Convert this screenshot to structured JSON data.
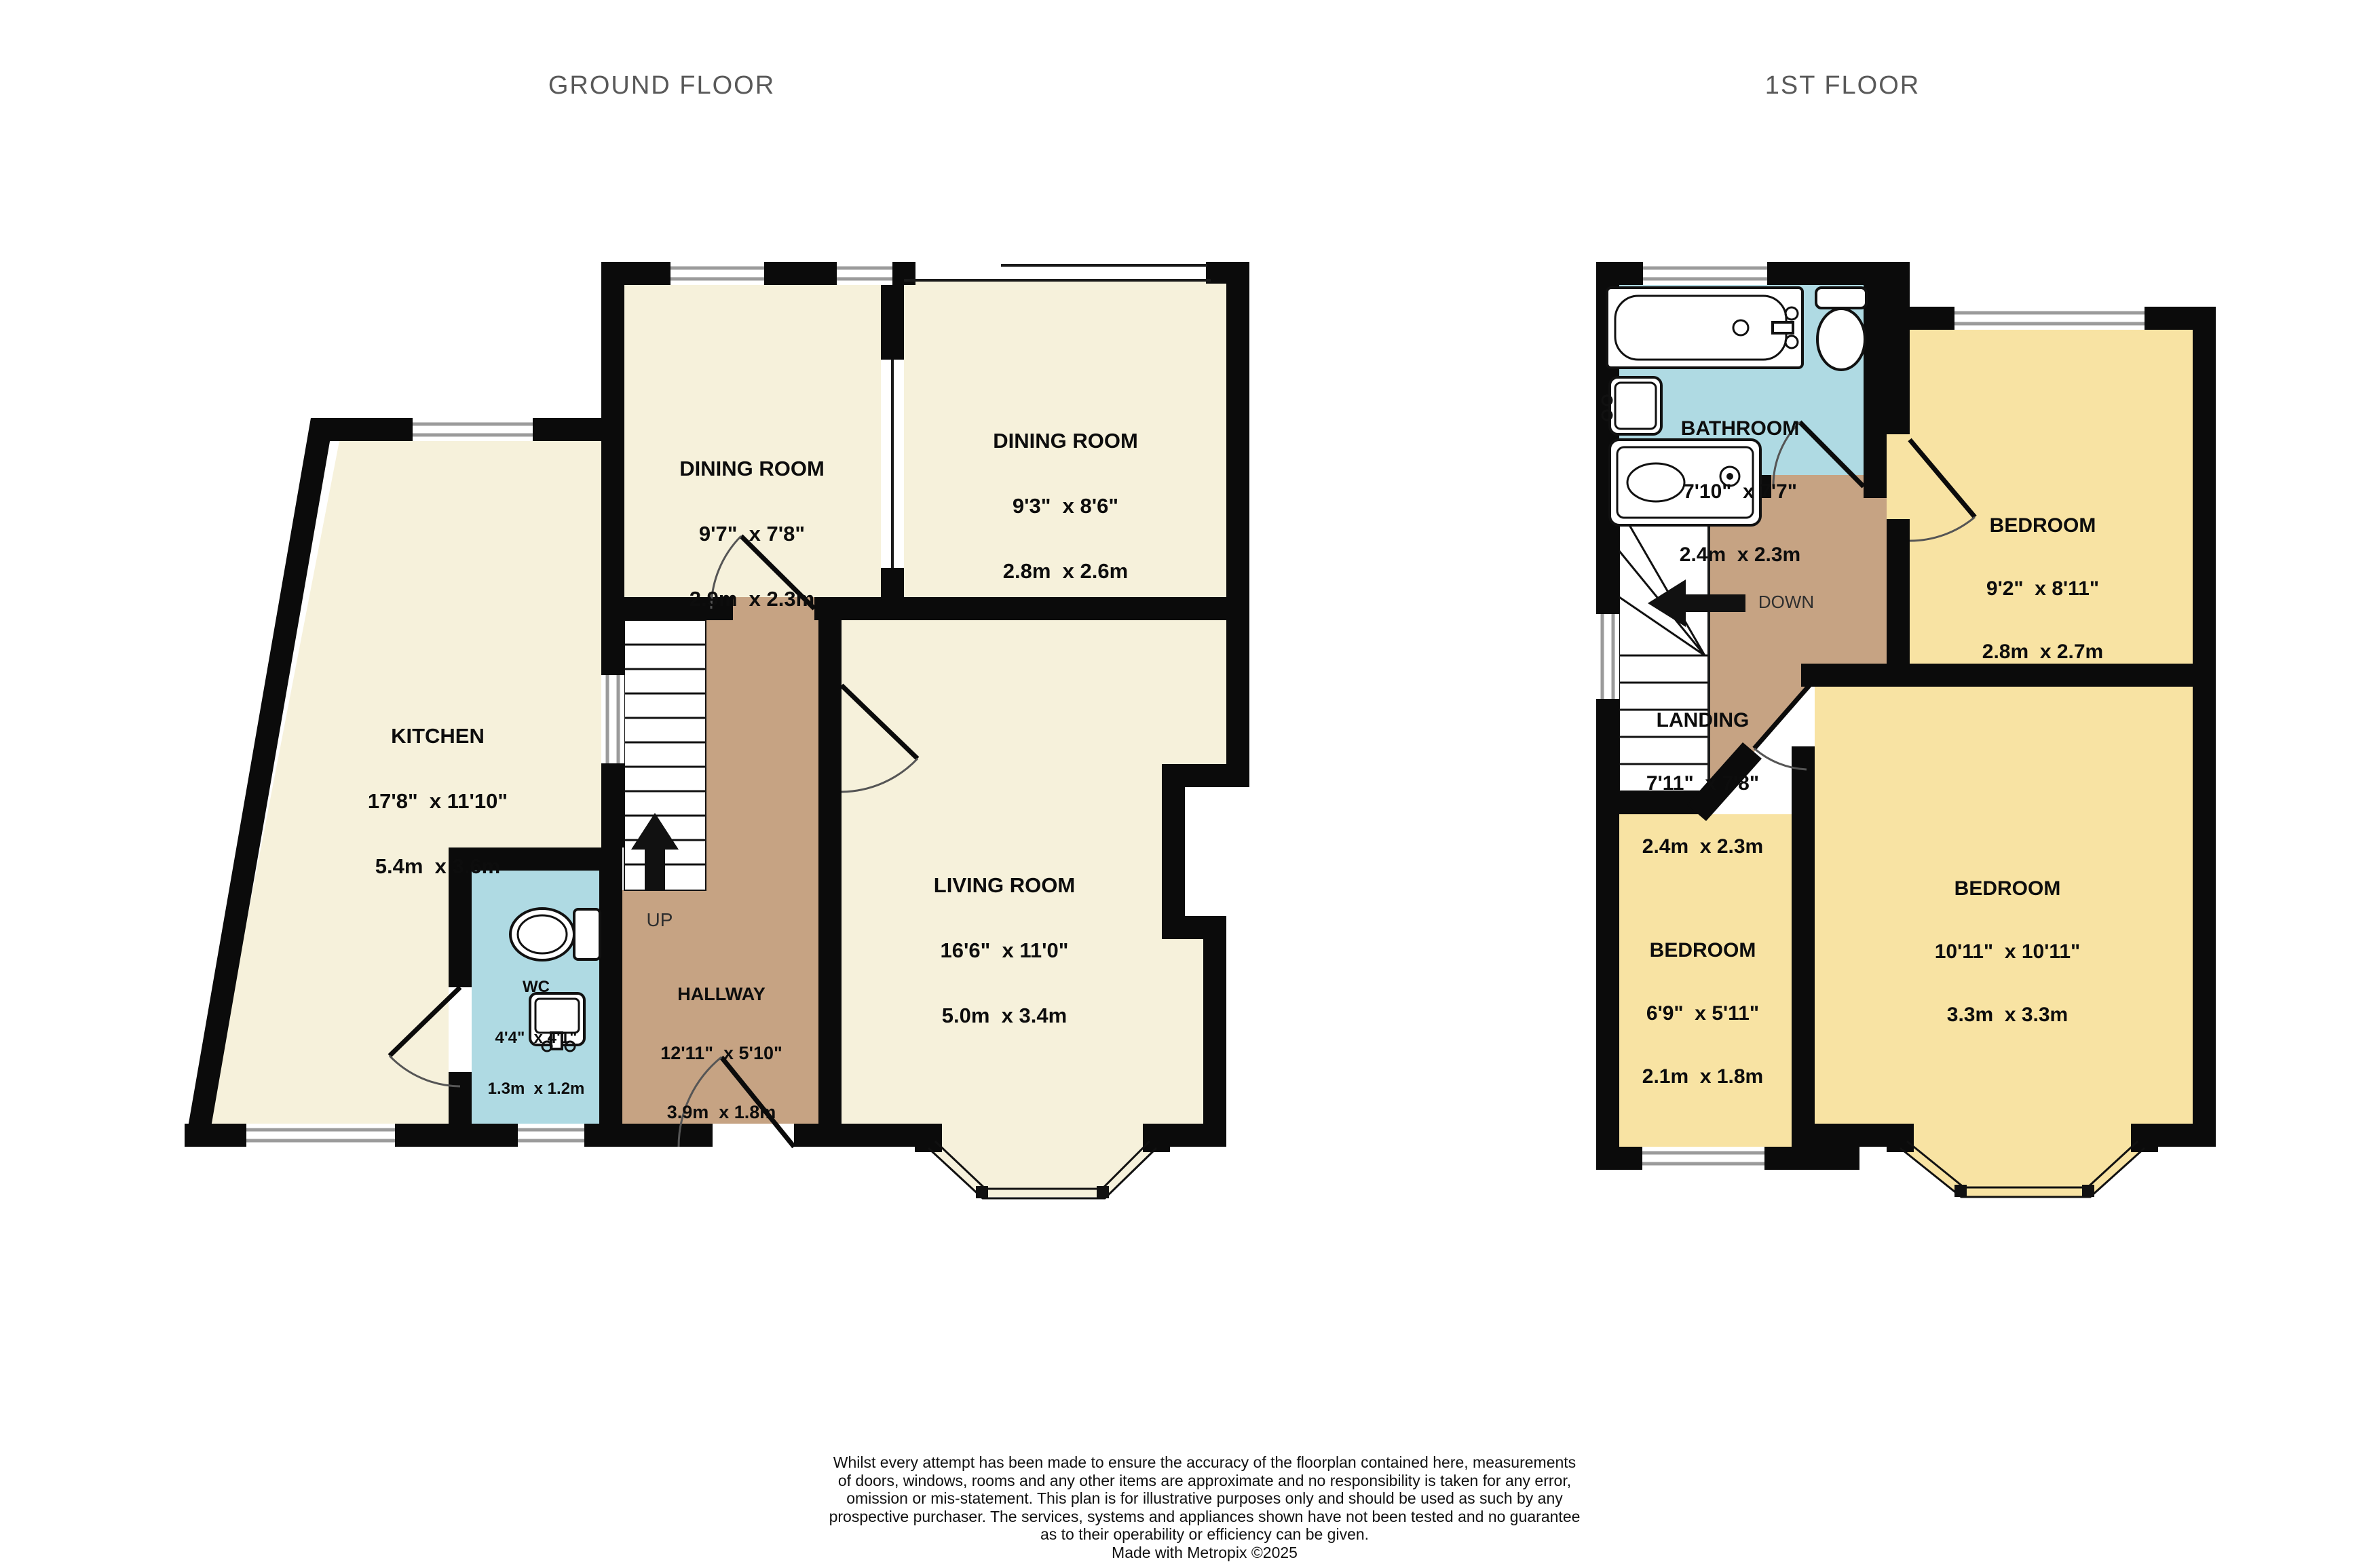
{
  "titles": {
    "ground": "GROUND FLOOR",
    "first": "1ST FLOOR"
  },
  "ground_floor": {
    "up_label": "UP",
    "rooms": {
      "dining1": {
        "name": "DINING ROOM",
        "imperial": "9'7\"  x 7'8\"",
        "metric": "2.9m  x 2.3m"
      },
      "dining2": {
        "name": "DINING ROOM",
        "imperial": "9'3\"  x 8'6\"",
        "metric": "2.8m  x 2.6m"
      },
      "kitchen": {
        "name": "KITCHEN",
        "imperial": "17'8\"  x 11'10\"",
        "metric": "5.4m  x 3.6m"
      },
      "living": {
        "name": "LIVING ROOM",
        "imperial": "16'6\"  x 11'0\"",
        "metric": "5.0m  x 3.4m"
      },
      "wc": {
        "name": "WC",
        "imperial": "4'4\"  x 4'1\"",
        "metric": "1.3m  x 1.2m"
      },
      "hallway": {
        "name": "HALLWAY",
        "imperial": "12'11\"  x 5'10\"",
        "metric": "3.9m  x 1.8m"
      }
    }
  },
  "first_floor": {
    "down_label": "DOWN",
    "rooms": {
      "bathroom": {
        "name": "BATHROOM",
        "imperial": "7'10\"  x 7'7\"",
        "metric": "2.4m  x 2.3m"
      },
      "bedroom1": {
        "name": "BEDROOM",
        "imperial": "9'2\"  x 8'11\"",
        "metric": "2.8m  x 2.7m"
      },
      "landing": {
        "name": "LANDING",
        "imperial": "7'11\"  x 7'8\"",
        "metric": "2.4m  x 2.3m"
      },
      "bedroom_small": {
        "name": "BEDROOM",
        "imperial": "6'9\"  x 5'11\"",
        "metric": "2.1m  x 1.8m"
      },
      "bedroom_big": {
        "name": "BEDROOM",
        "imperial": "10'11\"  x 10'11\"",
        "metric": "3.3m  x 3.3m"
      }
    }
  },
  "disclaimer": {
    "line1": "Whilst every attempt has been made to ensure the accuracy of the floorplan contained here, measurements",
    "line2": "of doors, windows, rooms and any other items are approximate and no responsibility is taken for any error,",
    "line3": "omission or mis-statement. This plan is for illustrative purposes only and should be used as such by any",
    "line4": "prospective purchaser. The services, systems and appliances shown have not been tested and no guarantee",
    "line5": "as to their operability or efficiency can be given.",
    "credit": "Made with Metropix ©2025"
  },
  "colors": {
    "room_cream": "#F6F1DB",
    "room_yellow": "#F8E3A3",
    "room_blue": "#AFDAE3",
    "room_tan": "#C6A383",
    "wall": "#0B0B0B"
  }
}
